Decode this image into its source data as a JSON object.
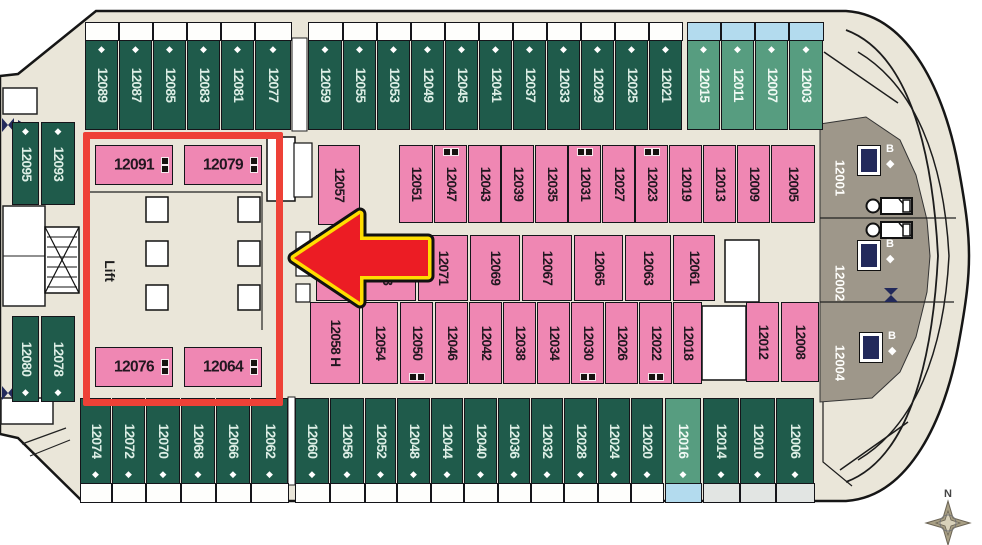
{
  "labels": {
    "lift": "Lift",
    "north": "N",
    "b": "B"
  },
  "colors": {
    "cabin_green": "#1f5b4b",
    "cabin_light_green": "#579d80",
    "cabin_pink": "#ef87b3",
    "suite_taupe": "#9e978a",
    "balcony_blue": "#b3dbee",
    "deck_beige": "#eae6d9",
    "highlight_red": "#ee4137",
    "arrow_red": "#ec1c24",
    "arrow_yellow": "#ffdd00",
    "icon_navy": "#22295b"
  },
  "cabins": [
    {
      "n": "12089",
      "x": 85,
      "y": 40,
      "w": 33,
      "h": 90,
      "t": "green",
      "dia": "top",
      "balc": "top white"
    },
    {
      "n": "12087",
      "x": 119,
      "y": 40,
      "w": 33,
      "h": 90,
      "t": "green",
      "dia": "top",
      "balc": "top white"
    },
    {
      "n": "12085",
      "x": 153,
      "y": 40,
      "w": 33,
      "h": 90,
      "t": "green",
      "dia": "top",
      "balc": "top white"
    },
    {
      "n": "12083",
      "x": 187,
      "y": 40,
      "w": 33,
      "h": 90,
      "t": "green",
      "dia": "top",
      "balc": "top white"
    },
    {
      "n": "12081",
      "x": 221,
      "y": 40,
      "w": 33,
      "h": 90,
      "t": "green",
      "dia": "top",
      "balc": "top white"
    },
    {
      "n": "12077",
      "x": 255,
      "y": 40,
      "w": 36,
      "h": 90,
      "t": "green",
      "dia": "top",
      "balc": "top white"
    },
    {
      "n": "12059",
      "x": 308,
      "y": 40,
      "w": 34,
      "h": 90,
      "t": "green",
      "dia": "top",
      "balc": "top white"
    },
    {
      "n": "12055",
      "x": 343,
      "y": 40,
      "w": 33,
      "h": 90,
      "t": "green",
      "dia": "top",
      "balc": "top white"
    },
    {
      "n": "12053",
      "x": 377,
      "y": 40,
      "w": 33,
      "h": 90,
      "t": "green",
      "dia": "top",
      "balc": "top white"
    },
    {
      "n": "12049",
      "x": 411,
      "y": 40,
      "w": 33,
      "h": 90,
      "t": "green",
      "dia": "top",
      "balc": "top white"
    },
    {
      "n": "12045",
      "x": 445,
      "y": 40,
      "w": 33,
      "h": 90,
      "t": "green",
      "dia": "top",
      "balc": "top white"
    },
    {
      "n": "12041",
      "x": 479,
      "y": 40,
      "w": 33,
      "h": 90,
      "t": "green",
      "dia": "top",
      "balc": "top white"
    },
    {
      "n": "12037",
      "x": 513,
      "y": 40,
      "w": 33,
      "h": 90,
      "t": "green",
      "dia": "top",
      "balc": "top white"
    },
    {
      "n": "12033",
      "x": 547,
      "y": 40,
      "w": 33,
      "h": 90,
      "t": "green",
      "dia": "top",
      "balc": "top white"
    },
    {
      "n": "12029",
      "x": 581,
      "y": 40,
      "w": 33,
      "h": 90,
      "t": "green",
      "dia": "top",
      "balc": "top white"
    },
    {
      "n": "12025",
      "x": 615,
      "y": 40,
      "w": 33,
      "h": 90,
      "t": "green",
      "dia": "top",
      "balc": "top white"
    },
    {
      "n": "12021",
      "x": 649,
      "y": 40,
      "w": 33,
      "h": 90,
      "t": "green",
      "dia": "top",
      "balc": "top white"
    },
    {
      "n": "12015",
      "x": 687,
      "y": 40,
      "w": 33,
      "h": 90,
      "t": "lightgreen",
      "dia": "top",
      "balc": "top blue"
    },
    {
      "n": "12011",
      "x": 721,
      "y": 40,
      "w": 33,
      "h": 90,
      "t": "lightgreen",
      "dia": "top",
      "balc": "top blue"
    },
    {
      "n": "12007",
      "x": 755,
      "y": 40,
      "w": 33,
      "h": 90,
      "t": "lightgreen",
      "dia": "top",
      "balc": "top blue"
    },
    {
      "n": "12003",
      "x": 789,
      "y": 40,
      "w": 34,
      "h": 90,
      "t": "lightgreen",
      "dia": "top",
      "balc": "top blue"
    },
    {
      "n": "12095",
      "x": 12,
      "y": 122,
      "w": 27,
      "h": 83,
      "t": "green",
      "dia": "top"
    },
    {
      "n": "12093",
      "x": 41,
      "y": 122,
      "w": 34,
      "h": 83,
      "t": "green",
      "dia": "top"
    },
    {
      "n": "12080",
      "x": 12,
      "y": 316,
      "w": 27,
      "h": 86,
      "t": "green",
      "dia": "bottom"
    },
    {
      "n": "12078",
      "x": 41,
      "y": 316,
      "w": 34,
      "h": 86,
      "t": "green",
      "dia": "bottom"
    },
    {
      "n": "12091",
      "x": 95,
      "y": 145,
      "w": 78,
      "h": 40,
      "t": "pink",
      "o": "h",
      "bunk": "right"
    },
    {
      "n": "12079",
      "x": 184,
      "y": 145,
      "w": 78,
      "h": 40,
      "t": "pink",
      "o": "h",
      "bunk": "right"
    },
    {
      "n": "12057",
      "x": 318,
      "y": 145,
      "w": 42,
      "h": 80,
      "t": "pink"
    },
    {
      "n": "12051",
      "x": 399,
      "y": 145,
      "w": 34,
      "h": 78,
      "t": "pink"
    },
    {
      "n": "12047",
      "x": 434,
      "y": 145,
      "w": 33,
      "h": 78,
      "t": "pink",
      "bunk": "top"
    },
    {
      "n": "12043",
      "x": 468,
      "y": 145,
      "w": 33,
      "h": 78,
      "t": "pink"
    },
    {
      "n": "12039",
      "x": 501,
      "y": 145,
      "w": 33,
      "h": 78,
      "t": "pink"
    },
    {
      "n": "12035",
      "x": 535,
      "y": 145,
      "w": 33,
      "h": 78,
      "t": "pink"
    },
    {
      "n": "12031",
      "x": 568,
      "y": 145,
      "w": 33,
      "h": 78,
      "t": "pink",
      "bunk": "top"
    },
    {
      "n": "12027",
      "x": 602,
      "y": 145,
      "w": 33,
      "h": 78,
      "t": "pink"
    },
    {
      "n": "12023",
      "x": 635,
      "y": 145,
      "w": 33,
      "h": 78,
      "t": "pink",
      "bunk": "top"
    },
    {
      "n": "12019",
      "x": 669,
      "y": 145,
      "w": 33,
      "h": 78,
      "t": "pink"
    },
    {
      "n": "12013",
      "x": 703,
      "y": 145,
      "w": 33,
      "h": 78,
      "t": "pink"
    },
    {
      "n": "12009",
      "x": 737,
      "y": 145,
      "w": 33,
      "h": 78,
      "t": "pink"
    },
    {
      "n": "12005",
      "x": 771,
      "y": 145,
      "w": 44,
      "h": 78,
      "t": "pink"
    },
    {
      "n": "12075",
      "x": 316,
      "y": 235,
      "w": 39,
      "h": 66,
      "t": "pink"
    },
    {
      "n": "12073",
      "x": 357,
      "y": 235,
      "w": 59,
      "h": 66,
      "t": "pink"
    },
    {
      "n": "12071",
      "x": 418,
      "y": 235,
      "w": 50,
      "h": 66,
      "t": "pink"
    },
    {
      "n": "12069",
      "x": 470,
      "y": 235,
      "w": 50,
      "h": 66,
      "t": "pink"
    },
    {
      "n": "12067",
      "x": 522,
      "y": 235,
      "w": 50,
      "h": 66,
      "t": "pink"
    },
    {
      "n": "12065",
      "x": 574,
      "y": 235,
      "w": 49,
      "h": 66,
      "t": "pink"
    },
    {
      "n": "12063",
      "x": 625,
      "y": 235,
      "w": 46,
      "h": 66,
      "t": "pink"
    },
    {
      "n": "12061",
      "x": 673,
      "y": 235,
      "w": 42,
      "h": 66,
      "t": "pink"
    },
    {
      "n": "12058 H",
      "x": 310,
      "y": 302,
      "w": 50,
      "h": 82,
      "t": "pink"
    },
    {
      "n": "12054",
      "x": 362,
      "y": 302,
      "w": 36,
      "h": 82,
      "t": "pink"
    },
    {
      "n": "12050",
      "x": 400,
      "y": 302,
      "w": 33,
      "h": 82,
      "t": "pink",
      "bunk": "bottom"
    },
    {
      "n": "12046",
      "x": 435,
      "y": 302,
      "w": 33,
      "h": 82,
      "t": "pink"
    },
    {
      "n": "12042",
      "x": 469,
      "y": 302,
      "w": 33,
      "h": 82,
      "t": "pink"
    },
    {
      "n": "12038",
      "x": 503,
      "y": 302,
      "w": 33,
      "h": 82,
      "t": "pink"
    },
    {
      "n": "12034",
      "x": 537,
      "y": 302,
      "w": 33,
      "h": 82,
      "t": "pink"
    },
    {
      "n": "12030",
      "x": 571,
      "y": 302,
      "w": 33,
      "h": 82,
      "t": "pink",
      "bunk": "bottom"
    },
    {
      "n": "12026",
      "x": 605,
      "y": 302,
      "w": 33,
      "h": 82,
      "t": "pink"
    },
    {
      "n": "12022",
      "x": 639,
      "y": 302,
      "w": 33,
      "h": 82,
      "t": "pink",
      "bunk": "bottom"
    },
    {
      "n": "12018",
      "x": 673,
      "y": 302,
      "w": 29,
      "h": 82,
      "t": "pink"
    },
    {
      "n": "12012",
      "x": 746,
      "y": 302,
      "w": 33,
      "h": 80,
      "t": "pink"
    },
    {
      "n": "12008",
      "x": 781,
      "y": 302,
      "w": 38,
      "h": 80,
      "t": "pink"
    },
    {
      "n": "12076",
      "x": 95,
      "y": 347,
      "w": 78,
      "h": 40,
      "t": "pink",
      "o": "h",
      "bunk": "right"
    },
    {
      "n": "12064",
      "x": 184,
      "y": 347,
      "w": 78,
      "h": 40,
      "t": "pink",
      "o": "h",
      "bunk": "right"
    },
    {
      "n": "12074",
      "x": 80,
      "y": 398,
      "w": 31,
      "h": 86,
      "t": "green",
      "dia": "bottom",
      "balc": "bottom white"
    },
    {
      "n": "12072",
      "x": 112,
      "y": 398,
      "w": 33,
      "h": 86,
      "t": "green",
      "dia": "bottom",
      "balc": "bottom white"
    },
    {
      "n": "12070",
      "x": 146,
      "y": 398,
      "w": 34,
      "h": 86,
      "t": "green",
      "dia": "bottom",
      "balc": "bottom white"
    },
    {
      "n": "12068",
      "x": 181,
      "y": 398,
      "w": 34,
      "h": 86,
      "t": "green",
      "dia": "bottom",
      "balc": "bottom white"
    },
    {
      "n": "12066",
      "x": 216,
      "y": 398,
      "w": 34,
      "h": 86,
      "t": "green",
      "dia": "bottom",
      "balc": "bottom white"
    },
    {
      "n": "12062",
      "x": 251,
      "y": 398,
      "w": 37,
      "h": 86,
      "t": "green",
      "dia": "bottom",
      "balc": "bottom white"
    },
    {
      "n": "12060",
      "x": 295,
      "y": 398,
      "w": 34,
      "h": 86,
      "t": "green",
      "dia": "bottom",
      "balc": "bottom white"
    },
    {
      "n": "12056",
      "x": 330,
      "y": 398,
      "w": 34,
      "h": 86,
      "t": "green",
      "dia": "bottom",
      "balc": "bottom white"
    },
    {
      "n": "12052",
      "x": 365,
      "y": 398,
      "w": 31,
      "h": 86,
      "t": "green",
      "dia": "bottom",
      "balc": "bottom white"
    },
    {
      "n": "12048",
      "x": 397,
      "y": 398,
      "w": 33,
      "h": 86,
      "t": "green",
      "dia": "bottom",
      "balc": "bottom white"
    },
    {
      "n": "12044",
      "x": 431,
      "y": 398,
      "w": 32,
      "h": 86,
      "t": "green",
      "dia": "bottom",
      "balc": "bottom white"
    },
    {
      "n": "12040",
      "x": 464,
      "y": 398,
      "w": 33,
      "h": 86,
      "t": "green",
      "dia": "bottom",
      "balc": "bottom white"
    },
    {
      "n": "12036",
      "x": 498,
      "y": 398,
      "w": 32,
      "h": 86,
      "t": "green",
      "dia": "bottom",
      "balc": "bottom white"
    },
    {
      "n": "12032",
      "x": 531,
      "y": 398,
      "w": 32,
      "h": 86,
      "t": "green",
      "dia": "bottom",
      "balc": "bottom white"
    },
    {
      "n": "12028",
      "x": 564,
      "y": 398,
      "w": 33,
      "h": 86,
      "t": "green",
      "dia": "bottom",
      "balc": "bottom white"
    },
    {
      "n": "12024",
      "x": 598,
      "y": 398,
      "w": 32,
      "h": 86,
      "t": "green",
      "dia": "bottom",
      "balc": "bottom white"
    },
    {
      "n": "12020",
      "x": 631,
      "y": 398,
      "w": 32,
      "h": 86,
      "t": "green",
      "dia": "bottom",
      "balc": "bottom white"
    },
    {
      "n": "12016",
      "x": 665,
      "y": 398,
      "w": 36,
      "h": 86,
      "t": "lightgreen",
      "dia": "bottom",
      "balc": "bottom blue"
    },
    {
      "n": "12014",
      "x": 703,
      "y": 398,
      "w": 36,
      "h": 86,
      "t": "green",
      "dia": "bottom",
      "balc": "bottom gray"
    },
    {
      "n": "12010",
      "x": 740,
      "y": 398,
      "w": 35,
      "h": 86,
      "t": "green",
      "dia": "bottom",
      "balc": "bottom gray"
    },
    {
      "n": "12006",
      "x": 776,
      "y": 398,
      "w": 38,
      "h": 86,
      "t": "green",
      "dia": "bottom",
      "balc": "bottom gray"
    },
    {
      "n": "12001",
      "x": 824,
      "y": 136,
      "w": 32,
      "h": 84,
      "t": "suite"
    },
    {
      "n": "12002",
      "x": 824,
      "y": 240,
      "w": 32,
      "h": 86,
      "t": "suite"
    },
    {
      "n": "12004",
      "x": 824,
      "y": 322,
      "w": 32,
      "h": 82,
      "t": "suite"
    }
  ],
  "b_icons": [
    {
      "x": 858,
      "y": 146
    },
    {
      "x": 858,
      "y": 241
    },
    {
      "x": 860,
      "y": 333
    }
  ]
}
